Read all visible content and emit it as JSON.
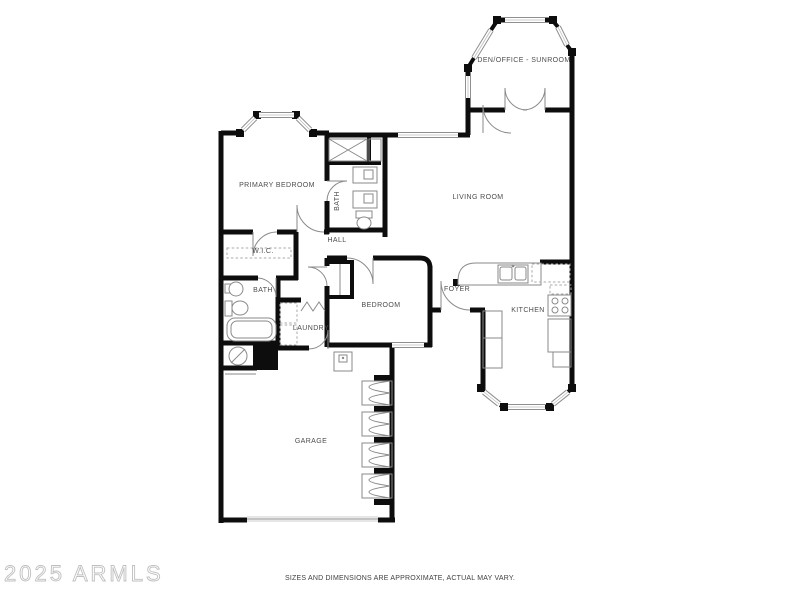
{
  "title": "Residential Floor Plan",
  "rooms": [
    {
      "id": "den-office-sunroom",
      "label": "DEN/OFFICE - SUNROOM"
    },
    {
      "id": "living-room",
      "label": "LIVING ROOM"
    },
    {
      "id": "primary-bedroom",
      "label": "PRIMARY BEDROOM"
    },
    {
      "id": "primary-bath",
      "label": "BATH"
    },
    {
      "id": "wic",
      "label": "W.I.C."
    },
    {
      "id": "hall",
      "label": "HALL"
    },
    {
      "id": "bath-2",
      "label": "BATH"
    },
    {
      "id": "laundry",
      "label": "LAUNDRY"
    },
    {
      "id": "bedroom",
      "label": "BEDROOM"
    },
    {
      "id": "foyer",
      "label": "FOYER"
    },
    {
      "id": "kitchen",
      "label": "KITCHEN"
    },
    {
      "id": "garage",
      "label": "GARAGE"
    }
  ],
  "watermark": {
    "text": "2025 ARMLS"
  },
  "footer": {
    "disclaimer": "SIZES AND DIMENSIONS ARE APPROXIMATE, ACTUAL MAY VARY."
  },
  "colors": {
    "wall": "#0d0d0d",
    "fixture": "#8a8a8a",
    "label": "#4d4d4d",
    "watermark": "#bfbfbf",
    "background": "#ffffff"
  }
}
